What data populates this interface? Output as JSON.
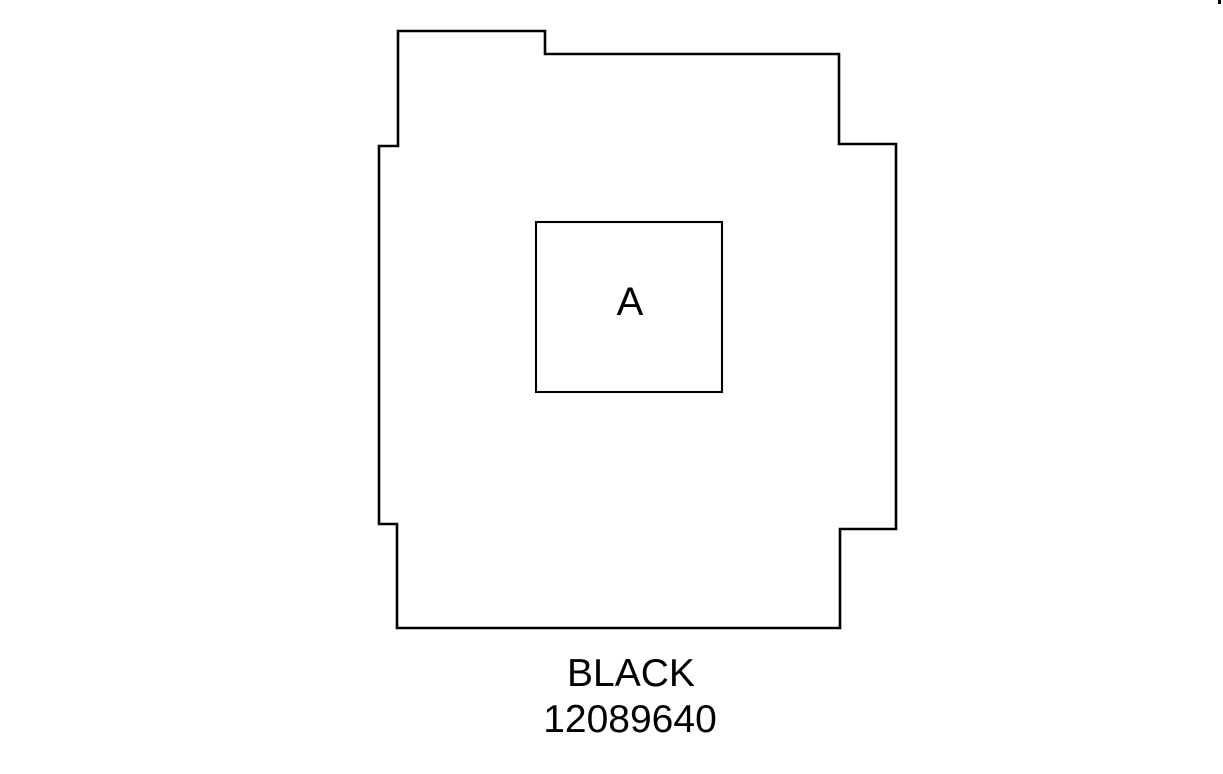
{
  "diagram": {
    "background_color": "#ffffff",
    "line_color": "#000000",
    "part_outline_points": "398,31 545,31 545,54 839,54 839,144 896,144 896,529 840,529 840,628 397,628 397,524 379,524 379,146 398,146",
    "cavity_box": {
      "x": 536,
      "y": 222,
      "width": 186,
      "height": 170
    },
    "cavity_label": {
      "text": "A",
      "x": 630,
      "y": 315
    },
    "caption": {
      "color_line": {
        "text": "BLACK",
        "x": 631,
        "y": 686
      },
      "part_number_line": {
        "text": "12089640",
        "x": 630,
        "y": 732
      }
    },
    "edge_artifact": {
      "x": 1218,
      "y": 0,
      "width": 3,
      "height": 4
    }
  }
}
